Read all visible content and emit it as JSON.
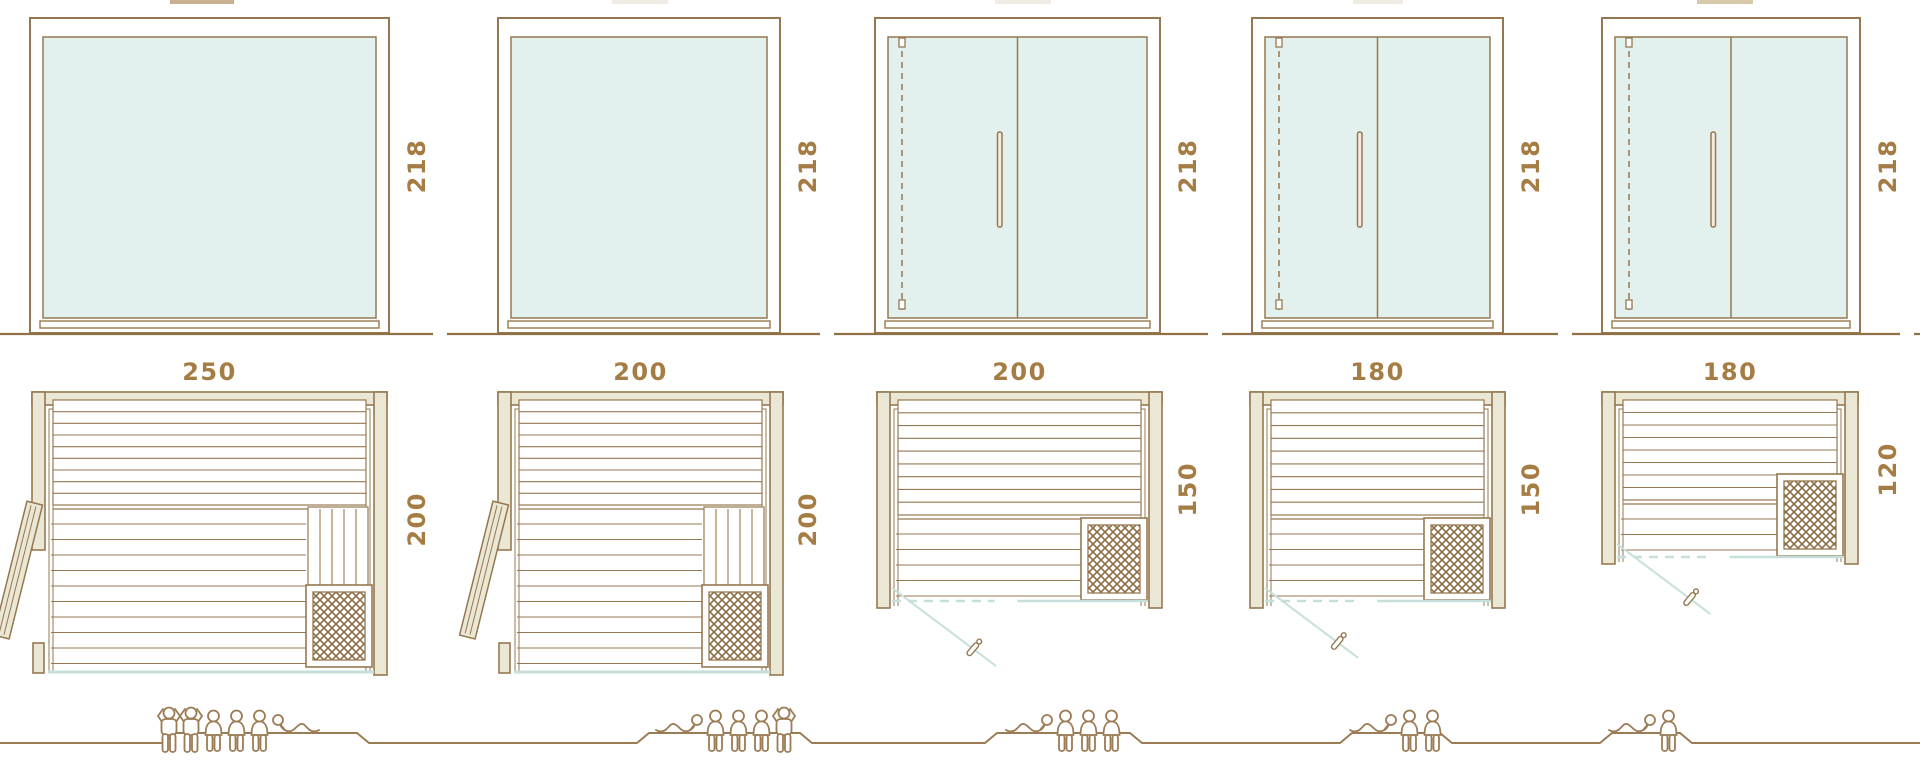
{
  "diagram": {
    "type": "sauna-model-size-comparison",
    "rows": [
      "front-elevation",
      "floor-plan",
      "capacity-figures"
    ],
    "saunas": [
      {
        "width": "250",
        "height": "218",
        "depth": "200",
        "front": "fixed-glass-panel",
        "door": "wood-side-door-open",
        "capacity": {
          "standing": 2,
          "seated": 3,
          "lying": 1,
          "total": 6
        }
      },
      {
        "width": "200",
        "height": "218",
        "depth": "200",
        "front": "fixed-glass-panel",
        "door": "wood-side-door-open",
        "capacity": {
          "standing": 1,
          "seated": 3,
          "lying": 1,
          "total": 5
        }
      },
      {
        "width": "200",
        "height": "218",
        "depth": "150",
        "front": "double-glass-door",
        "door": "glass-door-swing-open",
        "capacity": {
          "standing": 0,
          "seated": 3,
          "lying": 1,
          "total": 4
        }
      },
      {
        "width": "180",
        "height": "218",
        "depth": "150",
        "front": "double-glass-door",
        "door": "glass-door-swing-open",
        "capacity": {
          "standing": 0,
          "seated": 2,
          "lying": 1,
          "total": 3
        }
      },
      {
        "width": "180",
        "height": "218",
        "depth": "120",
        "front": "double-glass-door",
        "door": "glass-door-swing-open",
        "capacity": {
          "standing": 0,
          "seated": 1,
          "lying": 1,
          "total": 2
        }
      }
    ],
    "colors": {
      "outline": "#967850",
      "outline_dark": "#8f7145",
      "wall_fill": "#eae7d5",
      "glass_fill": "#e3f1ee",
      "glass_line": "#c5e0da",
      "label": "#a57d44",
      "figure": "#9b7c55",
      "lattice": "#8d6f47"
    }
  }
}
